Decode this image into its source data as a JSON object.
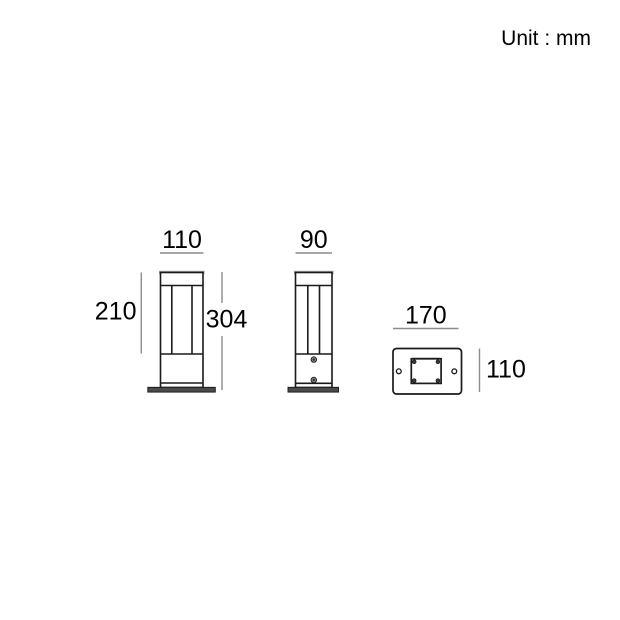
{
  "unit_label": "Unit : mm",
  "views": {
    "front": {
      "width_label": "110",
      "upper_height_label": "210",
      "total_height_label": "304"
    },
    "side": {
      "width_label": "90"
    },
    "base_plate": {
      "width_label": "170",
      "depth_label": "110"
    }
  },
  "colors": {
    "background": "#ffffff",
    "outline": "#1a1a1a",
    "dimension_line": "#8c8c8c",
    "text": "#000000",
    "plate_fill": "#4a4a4a",
    "shade": "#9e9e9e"
  }
}
